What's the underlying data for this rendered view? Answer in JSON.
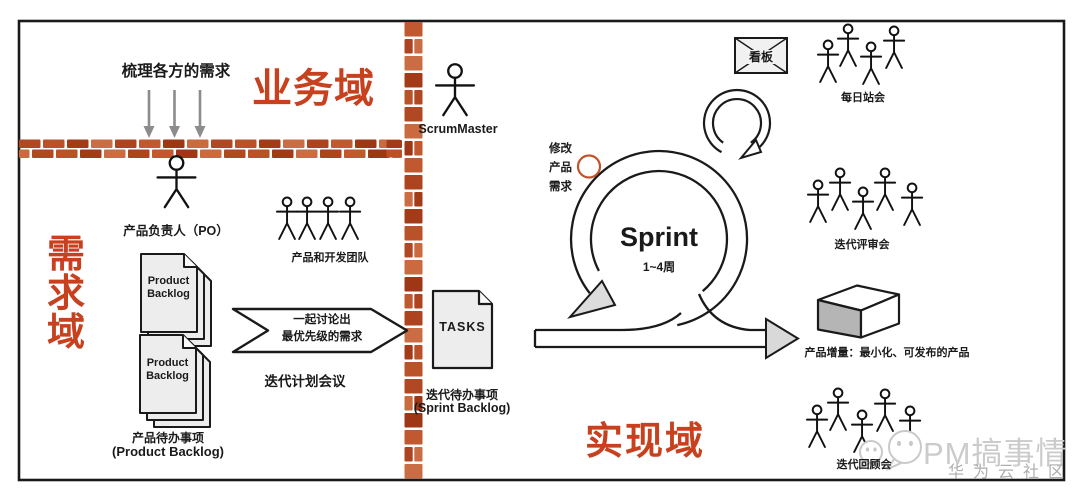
{
  "colors": {
    "accent_red": "#c8411f",
    "brick_base": "#b14824",
    "arrow_gray": "#8c8c8c",
    "watermark_gray": "#cbcbcb"
  },
  "domains": {
    "business": "业务域",
    "requirements": "需求域",
    "implementation": "实现域"
  },
  "business": {
    "groom_note": "梳理各方的需求",
    "po_caption": "产品负责人（PO）"
  },
  "requirements": {
    "backlog_doc1": "Product Backlog",
    "backlog_doc2": "Product Backlog",
    "backlog_caption": "产品待办事项",
    "backlog_caption_en": "(Product Backlog)",
    "team_caption": "产品和开发团队",
    "chevron_line1": "一起讨论出",
    "chevron_line2": "最优先级的需求",
    "planning_caption": "迭代计划会议"
  },
  "handoff": {
    "scrum_master": "ScrumMaster",
    "tasks_doc": "TASKS",
    "sprint_backlog_caption": "迭代待办事项",
    "sprint_backlog_caption_en": "(Sprint Backlog)"
  },
  "implementation": {
    "change_note_line1": "修改",
    "change_note_line2": "产品",
    "change_note_line3": "需求",
    "sprint_title": "Sprint",
    "sprint_duration": "1~4周",
    "kanban": "看板",
    "daily_standup": "每日站会",
    "review": "迭代评审会",
    "increment": "产品增量：最小化、可发布的产品",
    "retro": "迭代回顾会"
  },
  "watermark": {
    "brand": "PM搞事情",
    "community": "华为云社区"
  },
  "icons": {
    "person": "stick-figure-icon",
    "document": "document-icon",
    "kanban_board": "board-envelope-icon",
    "sprint_loop": "loop-arrow-icon",
    "increment_box": "product-box-icon",
    "watermark_logo": "wechat-bubbles-icon"
  }
}
